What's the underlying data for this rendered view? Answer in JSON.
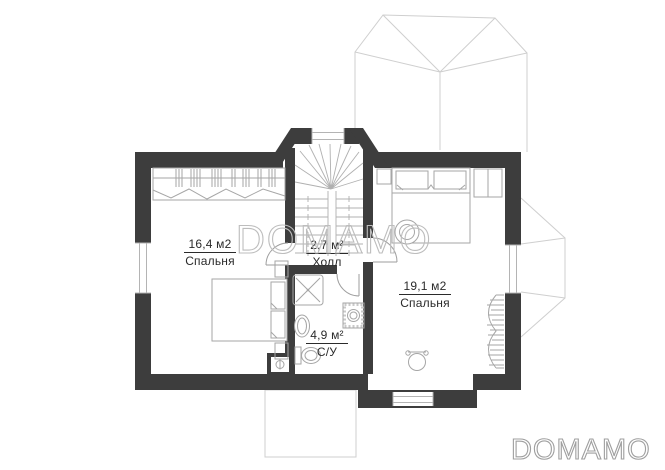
{
  "watermark": {
    "center": "DOMAMO",
    "logo": "DOMAMO"
  },
  "rooms": [
    {
      "id": "bedroom-left",
      "area": "16,4 м2",
      "name": "Спальня"
    },
    {
      "id": "hall",
      "area": "2,7 м²",
      "name": "Холл"
    },
    {
      "id": "bathroom",
      "area": "4,9 м²",
      "name": "С/У"
    },
    {
      "id": "bedroom-right",
      "area": "19,1 м2",
      "name": "Спальня"
    }
  ],
  "fixtures": [
    "staircase",
    "wardrobe",
    "double-bed",
    "nightstand",
    "dresser",
    "shower",
    "sink",
    "toilet",
    "washing-machine",
    "chimney",
    "plant-urn"
  ],
  "colors": {
    "wall": "#3d3d3d",
    "furn": "#a6a6a6",
    "stair": "#b0b0b0",
    "roof": "#cfcfcf",
    "winline": "#b4b4b4",
    "text": "#2b2b2b",
    "wm": "#bdbdbd",
    "logo": "#9f9f9f"
  }
}
